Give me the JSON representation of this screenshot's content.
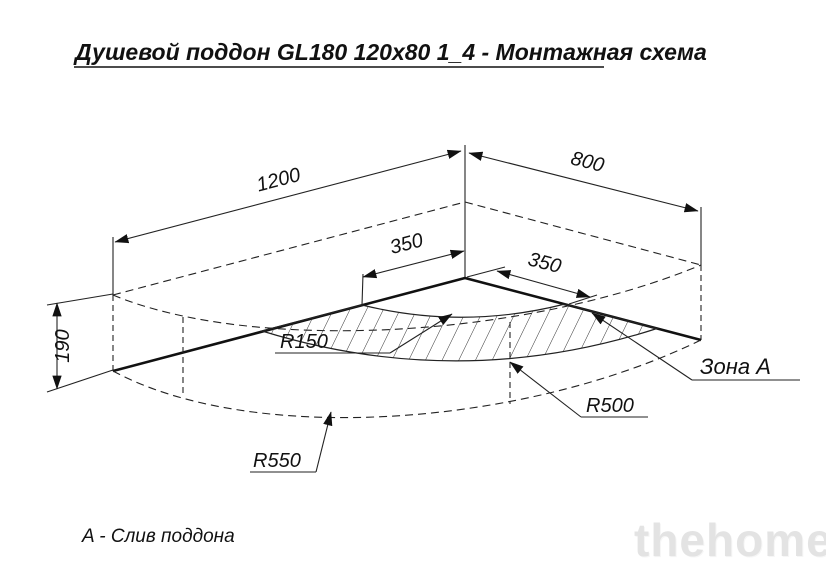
{
  "title": "Душевой поддон GL180 120x80 1_4 - Монтажная схема",
  "note": "A - Слив поддона",
  "watermark": "thehome",
  "dimensions": {
    "length": "1200",
    "width": "800",
    "height": "190",
    "drain_offset_left": "350",
    "drain_offset_right": "350"
  },
  "radii": {
    "inner": "R150",
    "zone": "R500",
    "outer": "R550"
  },
  "zone_label": "Зона A",
  "colors": {
    "line": "#222222",
    "background": "#ffffff",
    "watermark": "#e3e3e3"
  }
}
